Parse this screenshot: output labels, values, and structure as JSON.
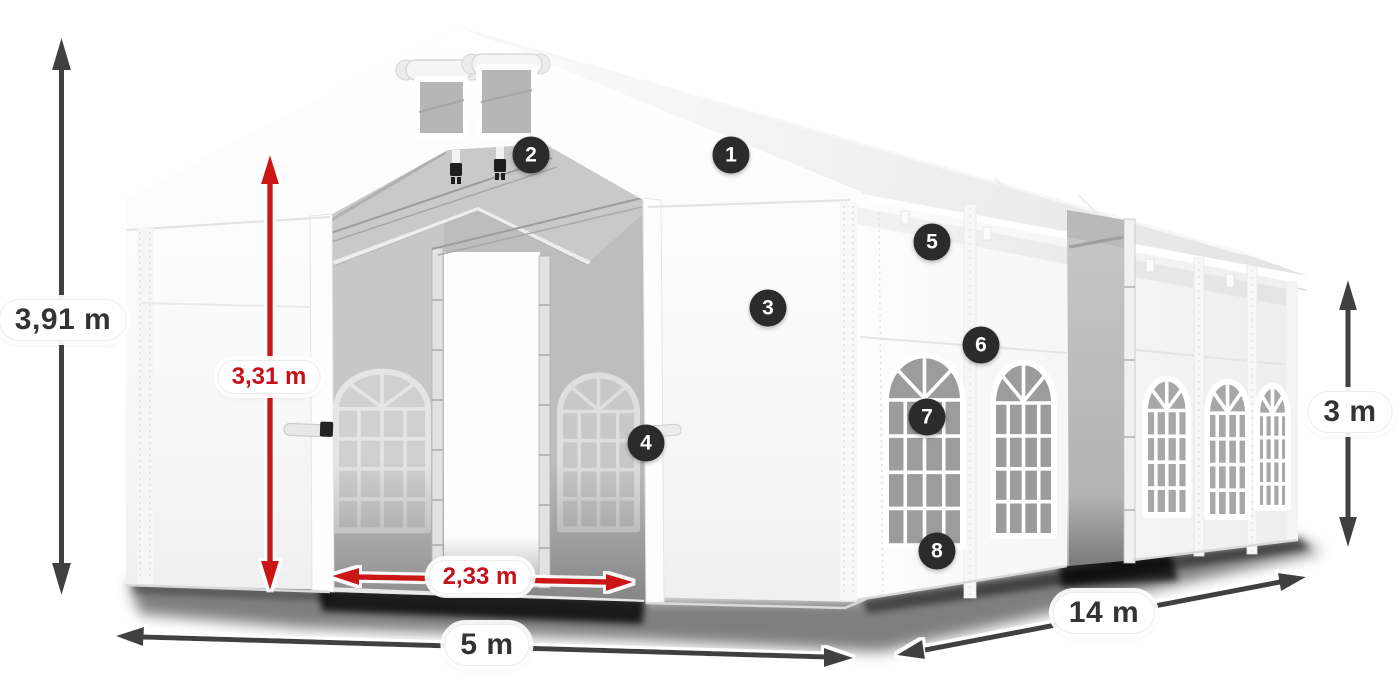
{
  "figure": {
    "kind": "product-dimension-diagram",
    "subject": "white marquee party tent, three-quarter view, open front entrance and open side door"
  },
  "dimensions": {
    "total_height": "3,91 m",
    "inner_height": "3,31 m",
    "entrance_width": "2,33 m",
    "front_width": "5 m",
    "side_length": "14 m",
    "side_height": "3 m"
  },
  "callouts": [
    {
      "label": "1"
    },
    {
      "label": "2"
    },
    {
      "label": "3"
    },
    {
      "label": "4"
    },
    {
      "label": "5"
    },
    {
      "label": "6"
    },
    {
      "label": "7"
    },
    {
      "label": "8"
    }
  ],
  "colors": {
    "accent_red": "#cc1215",
    "arrow_dark": "#3f3f3f",
    "badge_background": "#2b2b2b",
    "label_text": "#333333",
    "tent_white": "#ffffff"
  }
}
